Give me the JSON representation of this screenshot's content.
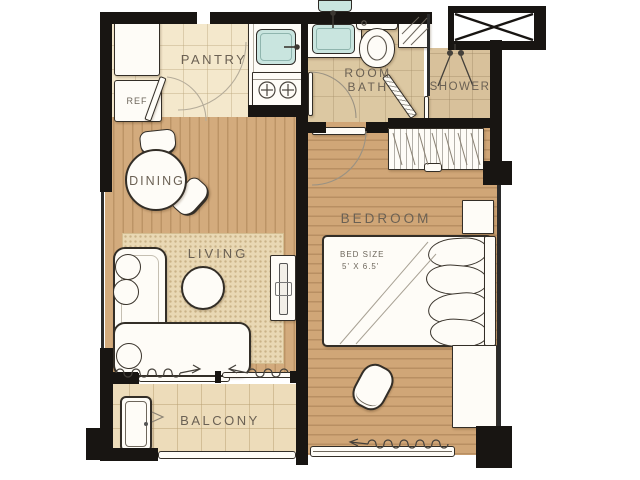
{
  "rooms": {
    "pantry": {
      "label": "PANTRY"
    },
    "bath": {
      "label_line1": "ROOM",
      "label_line2": "BATH"
    },
    "shower": {
      "label": "SHOWER"
    },
    "dining": {
      "label": "DINING"
    },
    "living": {
      "label": "LIVING"
    },
    "bedroom": {
      "label": "BEDROOM"
    },
    "balcony": {
      "label": "BALCONY"
    }
  },
  "annotations": {
    "refrigerator": "REF",
    "bed_size_line1": "BED SIZE",
    "bed_size_line2": "5' X 6.5'"
  },
  "colors": {
    "wall": "#181512",
    "wood_floor": "#d2a87a",
    "pantry_floor": "#f4e8cc",
    "bath_floor": "#dcc8a2",
    "balcony_floor": "#eddcba",
    "rug": "#e9d8b4",
    "fixture_basin": "#c9e5df",
    "label_text": "#6b6154"
  }
}
